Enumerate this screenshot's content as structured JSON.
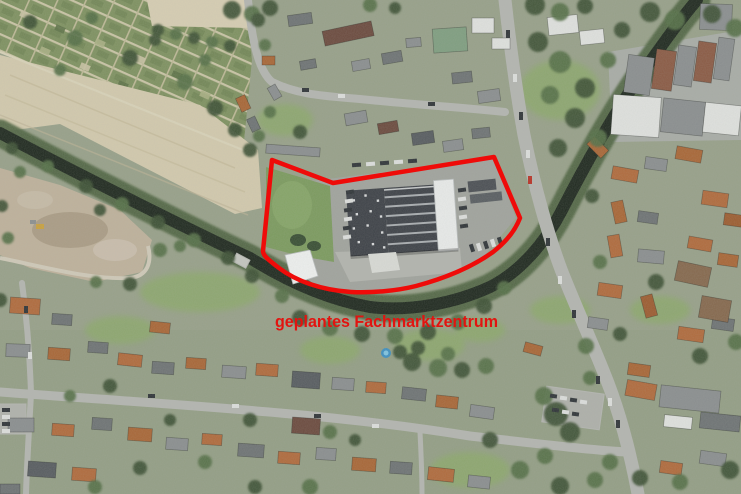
{
  "annotation": {
    "label": "geplantes Fachmarktzentrum",
    "label_color": "#e21410",
    "outline_color": "#ef0b09",
    "outline_path": "M272,160 L333,183 L494,157 L520,218 C515,231 506,242 493,252 C472,267 446,278 416,286 C396,291 372,293 351,292 C321,290 296,281 279,268 C270,261 263,256 263,251 Z"
  },
  "palette": {
    "water": "#1f291f",
    "river_bank": "#4e6440",
    "field": "#d2c9ad",
    "allotments": "#7e9160",
    "road": "#b3b5b0",
    "site_asphalt": "#a0a39d",
    "meadow": "#7b9a5e",
    "warehouse_roof_dark": "#3d4147",
    "warehouse_roof_white": "#e8eae9",
    "roof_orange": "#b06a3c",
    "roof_gray": "#6e7374",
    "construction": "#beb19b"
  }
}
